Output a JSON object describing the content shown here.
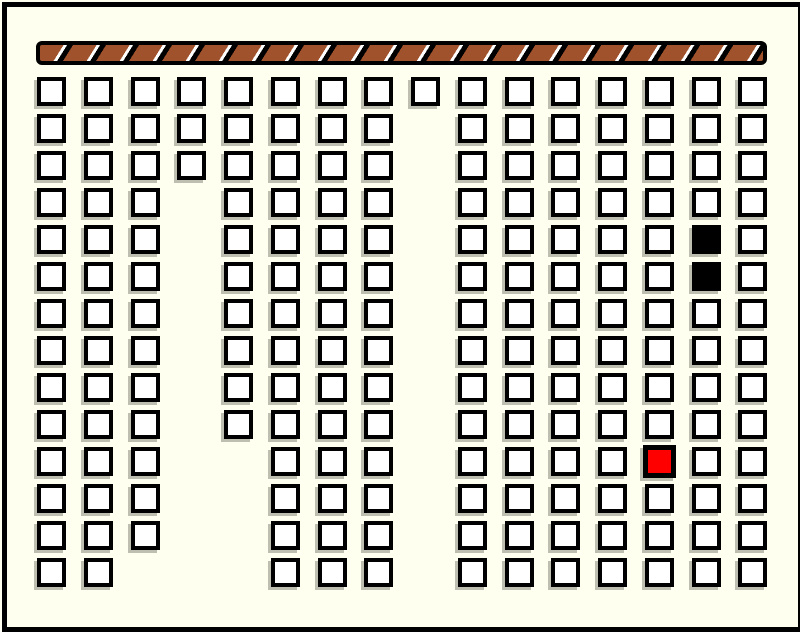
{
  "scene": {
    "description": "Seating floor plan: grid of seat squares facing a hatched front wall bar; two seats filled black, one seat highlighted red",
    "background_color": "#FFFFF0",
    "frame_border_color": "#000000"
  },
  "front_bar": {
    "x": 36,
    "y": 41,
    "width": 731,
    "height": 24,
    "fill_color": "#A0522D",
    "border_color": "#000000",
    "hatch_sliver_color": "#FFFFFF",
    "hatch_band_color": "#000000"
  },
  "seat_grid": {
    "rows": 14,
    "cols": 16,
    "col_x": [
      37,
      84,
      131,
      177,
      224,
      271,
      318,
      364,
      411,
      458,
      505,
      551,
      598,
      645,
      692,
      738
    ],
    "row_y": [
      77,
      114,
      151,
      188,
      225,
      262,
      299,
      336,
      373,
      410,
      447,
      484,
      521,
      558
    ],
    "seat_size": 29,
    "colors": {
      "W": "#FFFFFF",
      "B": "#000000",
      "R": "#FF0000"
    },
    "legend": {
      "W": "white-seat",
      "B": "black-filled-seat",
      "R": "red-highlighted-seat",
      ".": "empty-aisle"
    },
    "layout": [
      "WWWWWWWWWWWWWWWW",
      "WWWWWWWW.WWWWWWW",
      "WWWWWWWW.WWWWWWW",
      "WWW.WWWW.WWWWWWW",
      "WWW.WWWW.WWWWWBW",
      "WWW.WWWW.WWWWWBW",
      "WWW.WWWW.WWWWWWW",
      "WWW.WWWW.WWWWWWW",
      "WWW.WWWW.WWWWWWW",
      "WWW.WWWW.WWWWWWW",
      "WWW..WWW.WWWWRWW",
      "WWW..WWW.WWWWWWW",
      "WWW..WWW.WWWWWWW",
      "WW...WWW.WWWWWWW"
    ],
    "counts": {
      "white_seats": 192,
      "black_seats": 2,
      "red_seats": 1
    }
  }
}
